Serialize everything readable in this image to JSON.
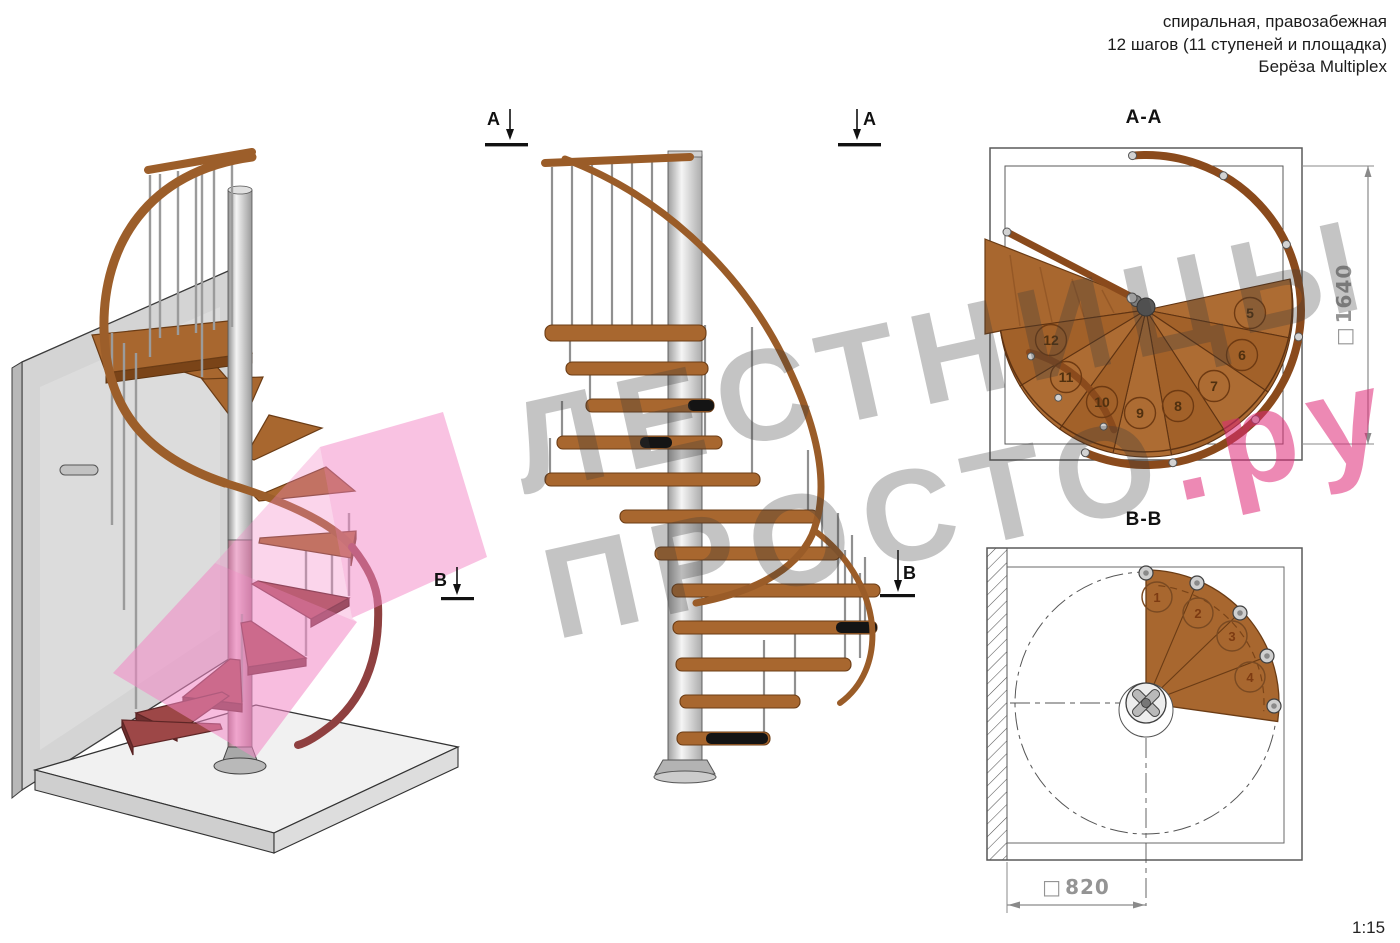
{
  "header": {
    "line1": "спиральная, правозабежная",
    "line2": "12 шагов (11 ступеней и площадка)",
    "line3": "Берёза Multiplex"
  },
  "watermark": {
    "line1": "ЛЕСТНИЦЫ",
    "line2_gray": "ПРОСТО",
    "line2_accent": ".ру"
  },
  "markers": {
    "a_left": "A",
    "a_right": "A",
    "b_elevation": "B",
    "b_iso": "B"
  },
  "plan_aa": {
    "title": "A-A",
    "square_symbol": "□",
    "dimension": "1640",
    "steps": [
      "5",
      "6",
      "7",
      "8",
      "9",
      "10",
      "11",
      "12"
    ]
  },
  "plan_bb": {
    "title": "B-B",
    "square_symbol": "□",
    "dimension": "820",
    "steps": [
      "1",
      "2",
      "3",
      "4"
    ]
  },
  "scale_label": "1:15",
  "colors": {
    "wood": "#a8672f",
    "wood_dark": "#6b3c15",
    "handrail": "#8a4a1c",
    "step_cut_maroon": "#9d4747",
    "metal_light": "#e8e8e8",
    "metal_mid": "#b5b5b5",
    "wall_gray": "#d4d4d4",
    "floor_gray": "#f1f1f1",
    "section_plane_pink": "#f386c5",
    "watermark_gray": "#b7b7b7",
    "watermark_pink": "#de2876",
    "dimension_gray": "#949494",
    "line_black": "#1a1a1a"
  }
}
